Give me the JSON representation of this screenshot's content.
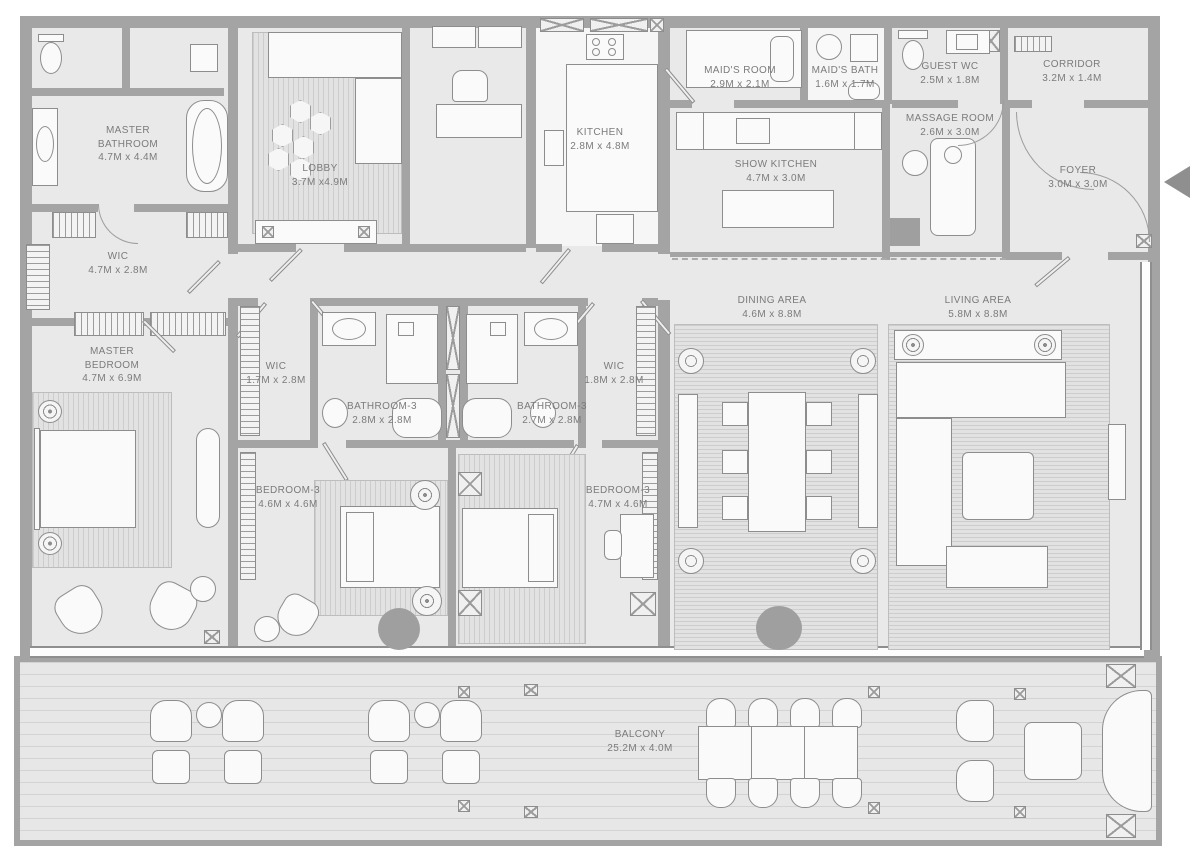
{
  "plan": {
    "colors": {
      "wall": "#a4a4a4",
      "floor": "#e9e9e9",
      "rug_line": "#cdcdcd",
      "label_text": "#7b7b7b",
      "accent_gray": "#9f9f9f",
      "furniture": "#fafafa"
    },
    "rooms": {
      "master_bathroom": {
        "name": "MASTER BATHROOM",
        "dims": "4.7M x 4.4M"
      },
      "wic_master": {
        "name": "WIC",
        "dims": "4.7M x 2.8M"
      },
      "master_bedroom": {
        "name": "MASTER BEDROOM",
        "dims": "4.7M x 6.9M"
      },
      "lobby": {
        "name": "LOBBY",
        "dims": "3.7M x4.9M"
      },
      "kitchen": {
        "name": "KITCHEN",
        "dims": "2.8M x 4.8M"
      },
      "maids_room": {
        "name": "MAID'S ROOM",
        "dims": "2.9M x 2.1M"
      },
      "maids_bath": {
        "name": "MAID'S BATH",
        "dims": "1.6M x 1.7M"
      },
      "guest_wc": {
        "name": "GUEST WC",
        "dims": "2.5M x 1.8M"
      },
      "corridor": {
        "name": "CORRIDOR",
        "dims": "3.2M x 1.4M"
      },
      "foyer": {
        "name": "FOYER",
        "dims": "3.0M x 3.0M"
      },
      "show_kitchen": {
        "name": "SHOW KITCHEN",
        "dims": "4.7M x 3.0M"
      },
      "massage_room": {
        "name": "MASSAGE ROOM",
        "dims": "2.6M x 3.0M"
      },
      "wic_left": {
        "name": "WIC",
        "dims": "1.7M x 2.8M"
      },
      "bathroom3_left": {
        "name": "BATHROOM-3",
        "dims": "2.8M x 2.8M"
      },
      "bathroom3_right": {
        "name": "BATHROOM-3",
        "dims": "2.7M x 2.8M"
      },
      "wic_right": {
        "name": "WIC",
        "dims": "1.8M x 2.8M"
      },
      "bedroom3_left": {
        "name": "BEDROOM-3",
        "dims": "4.6M x 4.6M"
      },
      "bedroom3_right": {
        "name": "BEDROOM-3",
        "dims": "4.7M x 4.6M"
      },
      "dining_area": {
        "name": "DINING AREA",
        "dims": "4.6M x 8.8M"
      },
      "living_area": {
        "name": "LIVING AREA",
        "dims": "5.8M x 8.8M"
      },
      "balcony": {
        "name": "BALCONY",
        "dims": "25.2M x 4.0M"
      }
    }
  }
}
